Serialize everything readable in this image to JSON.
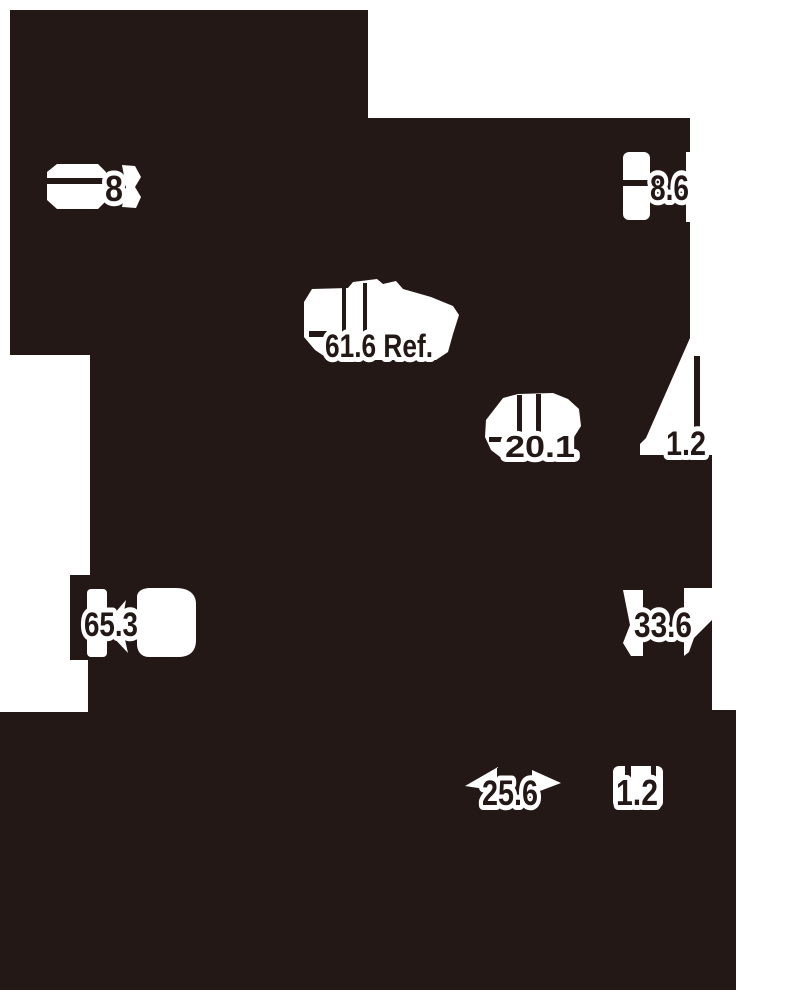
{
  "meta": {
    "kind": "technical-drawing",
    "description": "High-contrast binarized engineering drawing of a mechanical part silhouette with white dimension callouts"
  },
  "colors": {
    "ink": "#231815",
    "paper": "#ffffff"
  },
  "dimensions": [
    {
      "id": "dim-8",
      "label": "8"
    },
    {
      "id": "dim-8-6",
      "label": "8.6"
    },
    {
      "id": "dim-61-6-ref",
      "label": "61.6 Ref."
    },
    {
      "id": "dim-20-1",
      "label": "20.1"
    },
    {
      "id": "dim-1-2-upper",
      "label": "1.2"
    },
    {
      "id": "dim-65-3",
      "label": "65.3"
    },
    {
      "id": "dim-33-6",
      "label": "33.6"
    },
    {
      "id": "dim-25-6",
      "label": "25.6"
    },
    {
      "id": "dim-1-2-lower",
      "label": "1.2"
    }
  ]
}
